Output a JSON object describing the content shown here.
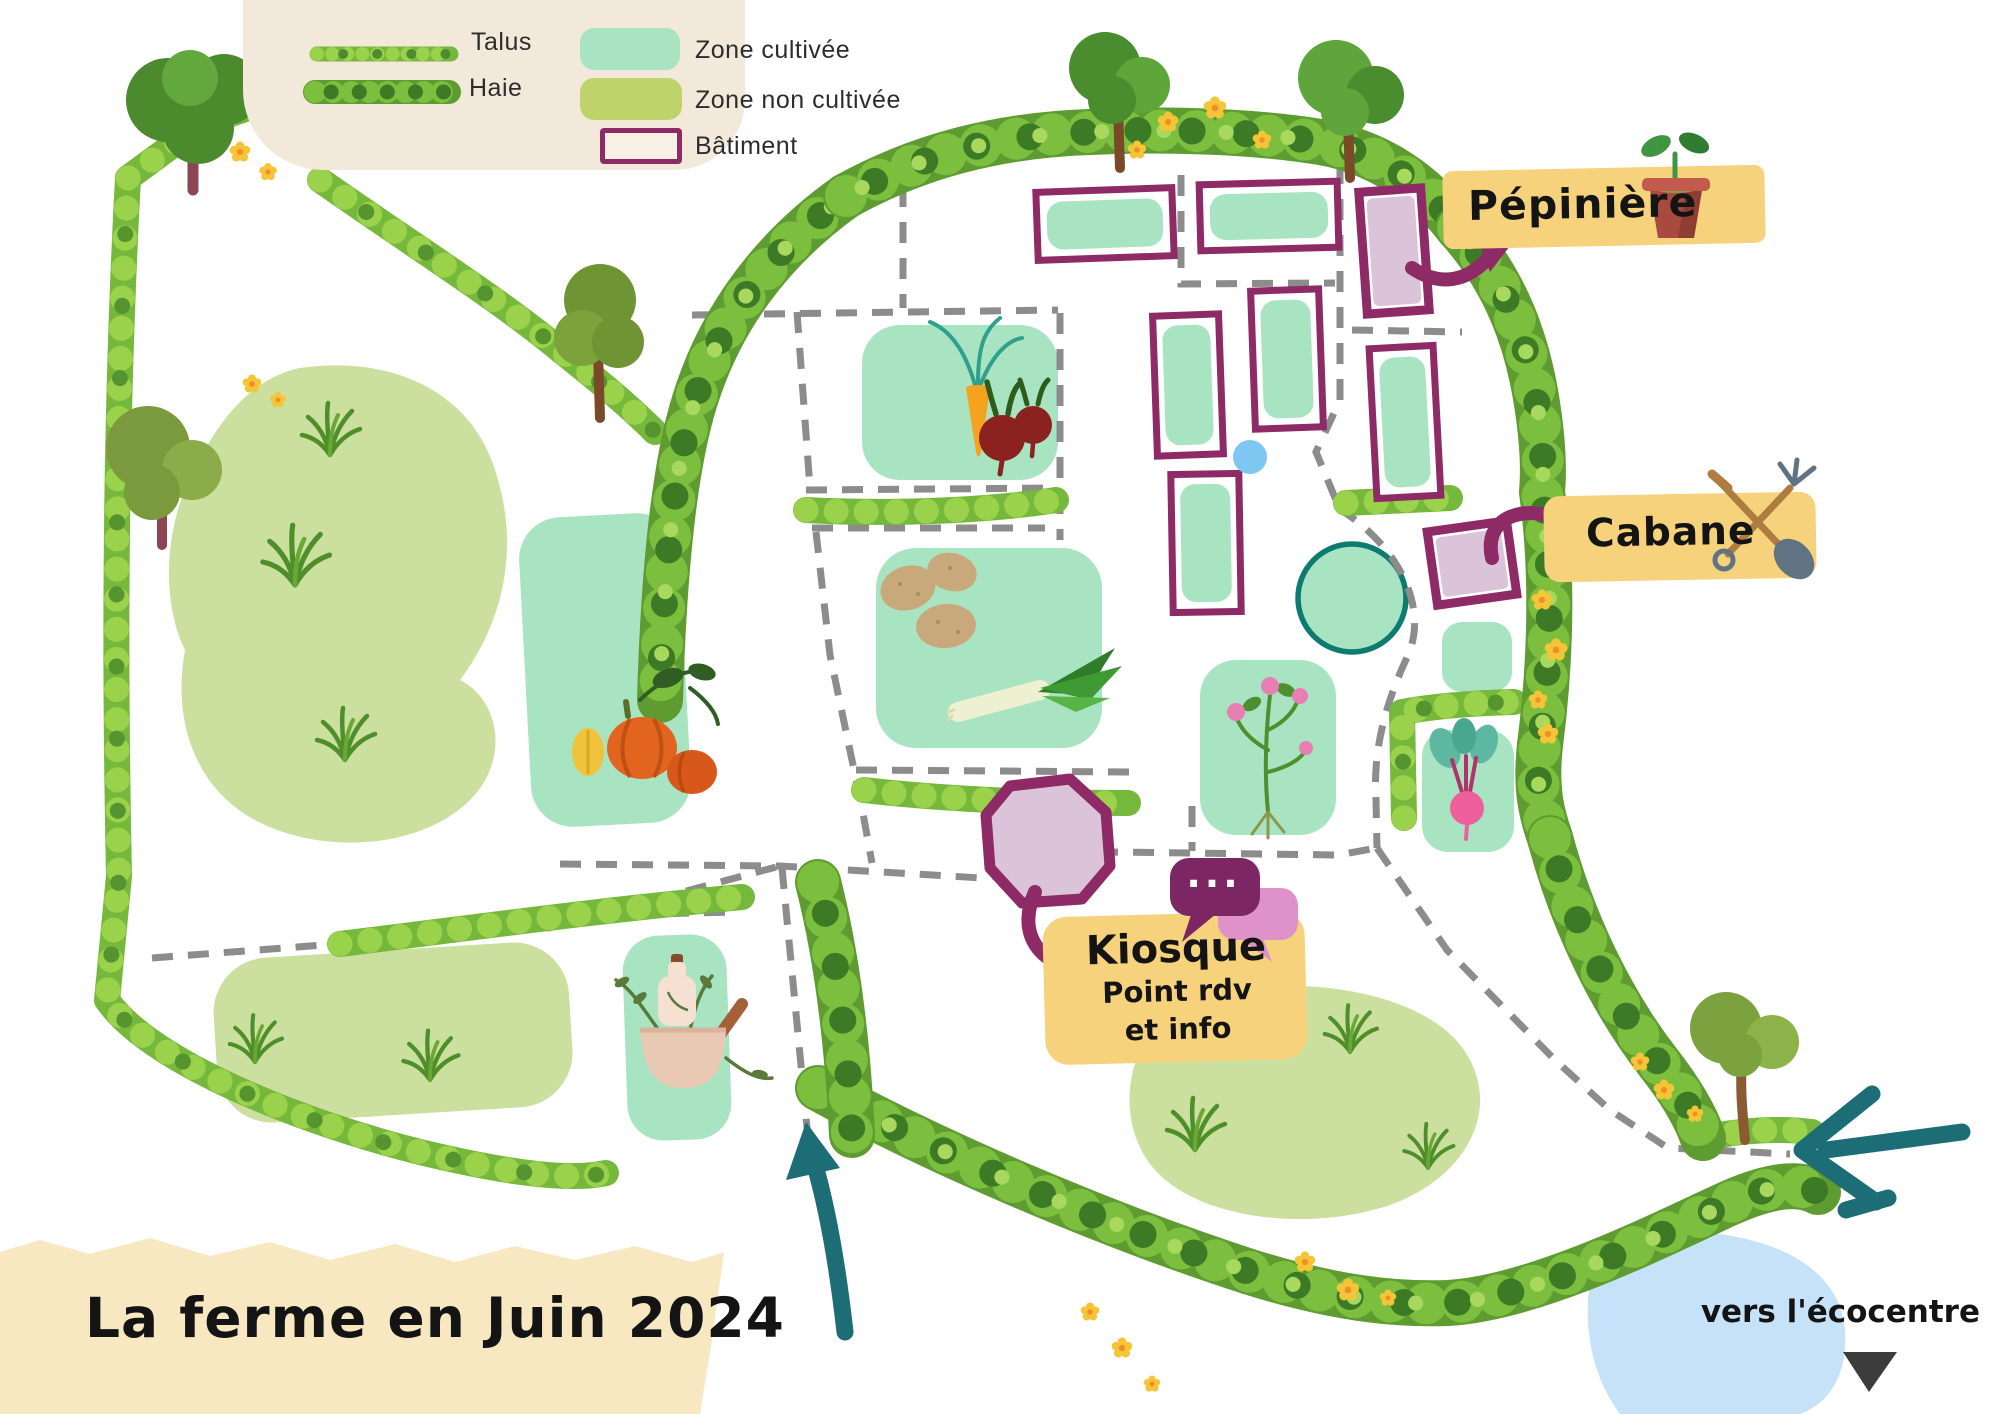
{
  "title": {
    "text": "La ferme en Juin 2024"
  },
  "legend": {
    "items": [
      {
        "label": "Talus",
        "icon": "talus-hedge-icon"
      },
      {
        "label": "Haie",
        "icon": "haie-hedge-icon"
      },
      {
        "label": "Zone cultivée",
        "swatch": "#a9e4c2"
      },
      {
        "label": "Zone non cultivée",
        "swatch": "#bfd36b"
      },
      {
        "label": "Bâtiment",
        "swatch_border": "#8e2a66"
      }
    ]
  },
  "callouts": {
    "pepiniere": {
      "label": "Pépinière",
      "icon": "seedling-pot-icon"
    },
    "cabane": {
      "label": "Cabane",
      "icon": "garden-tools-icon"
    },
    "kiosque": {
      "title": "Kiosque",
      "line1": "Point rdv",
      "line2": "et info",
      "bubble_dots": "...",
      "icon": "speech-bubbles-icon"
    }
  },
  "footer": {
    "ecocentre": "vers l'écocentre",
    "direction_icon": "down-triangle-icon"
  },
  "entrances": {
    "bottom": "teal-arrow-up",
    "right": "teal-arrow-left"
  },
  "palette": {
    "cultivated_mint": "#a9e4c2",
    "uncultivated_olive": "#bfd36b",
    "meadow_olive": "#cbdf9e",
    "hedge_green": "#76b83c",
    "hedge_dark": "#3d7a26",
    "building_purple": "#8e2a66",
    "building_fill": "#dbc4da",
    "label_yellow": "#f5d27b",
    "legend_beige": "#f2e9da",
    "banner_cream": "#f8e8c2",
    "path_gray": "#8c8c8c",
    "water_blue": "#c6e2f8",
    "pond_blue": "#c6e2f8",
    "arrow_teal": "#1c6d75",
    "basin_ring_teal": "#0e7b70"
  }
}
